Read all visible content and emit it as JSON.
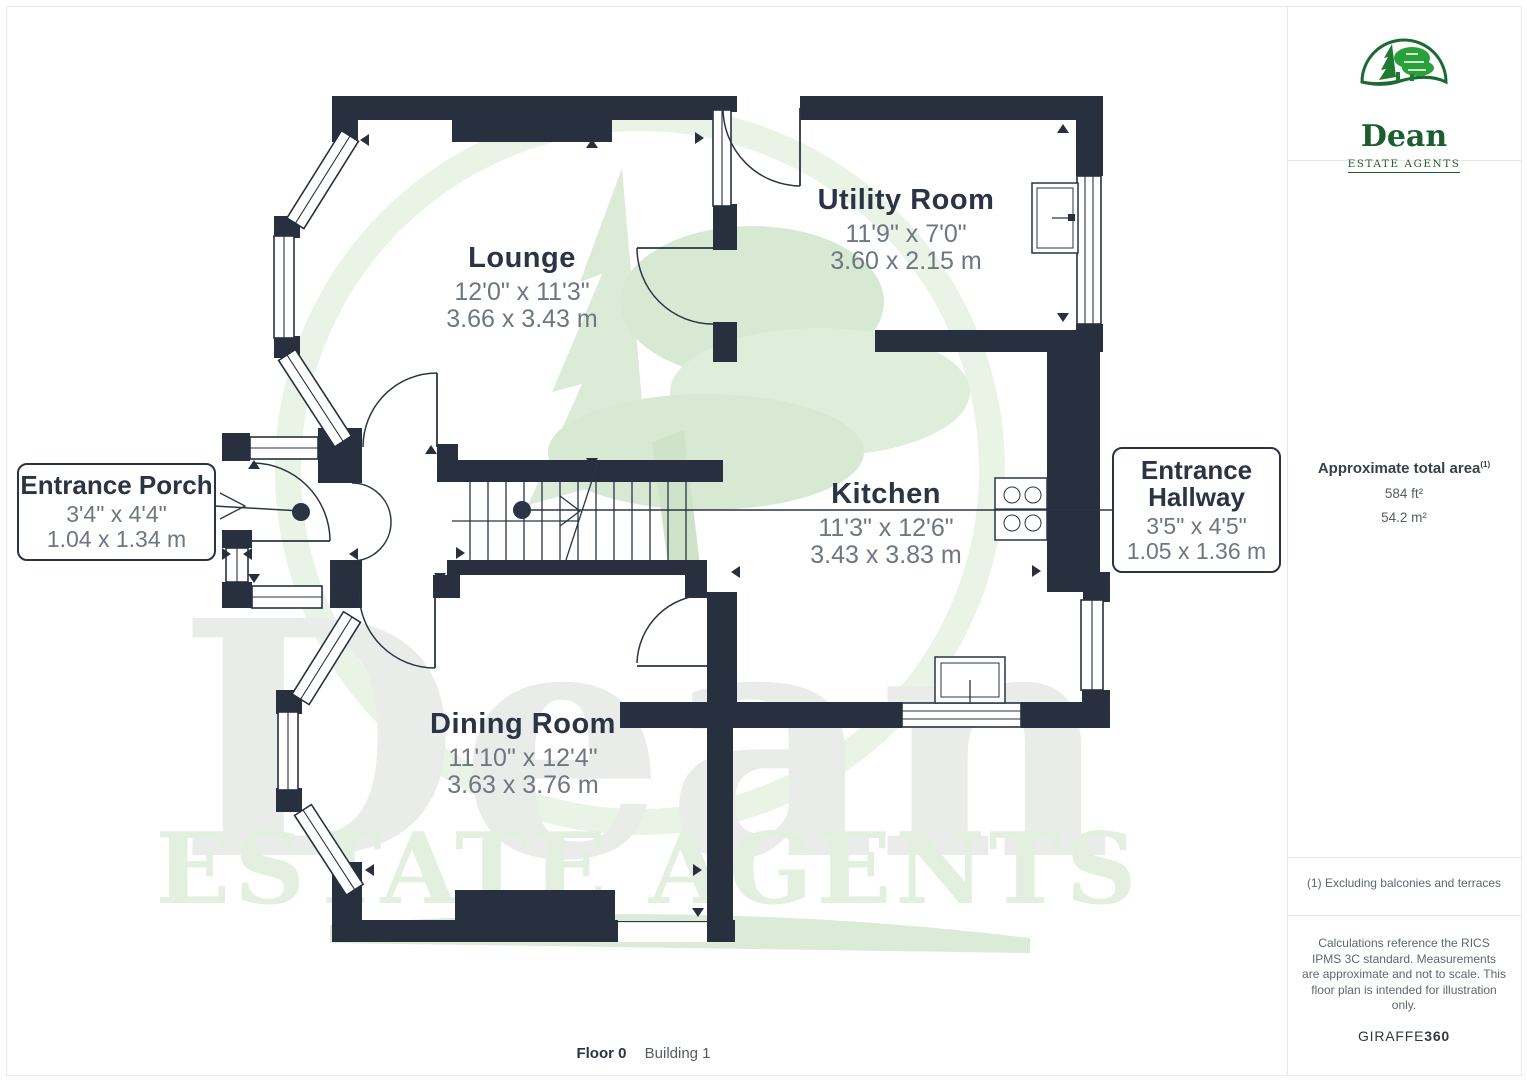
{
  "plan": {
    "rooms": [
      {
        "name": "Lounge",
        "imperial": "12'0\" x 11'3\"",
        "metric": "3.66 x 3.43 m"
      },
      {
        "name": "Utility Room",
        "imperial": "11'9\" x 7'0\"",
        "metric": "3.60 x 2.15 m"
      },
      {
        "name": "Kitchen",
        "imperial": "11'3\" x 12'6\"",
        "metric": "3.43 x 3.83 m"
      },
      {
        "name": "Dining Room",
        "imperial": "11'10\" x 12'4\"",
        "metric": "3.63 x 3.76 m"
      }
    ],
    "callouts": [
      {
        "name": "Entrance Porch",
        "imperial": "3'4\" x 4'4\"",
        "metric": "1.04 x 1.34 m"
      },
      {
        "line1": "Entrance",
        "line2": "Hallway",
        "imperial": "3'5\" x 4'5\"",
        "metric": "1.05 x 1.36 m"
      }
    ]
  },
  "watermark": {
    "word": "Dean",
    "tagline": "ESTATE AGENTS"
  },
  "sidebar": {
    "logo": {
      "name": "Dean",
      "tagline": "ESTATE AGENTS"
    },
    "area": {
      "label": "Approximate total area",
      "superscript": "(1)",
      "imperial": "584 ft²",
      "metric": "54.2 m²"
    },
    "footnote": "(1) Excluding balconies and terraces",
    "disclaimer": "Calculations reference the RICS IPMS 3C standard. Measurements are approximate and not to scale. This floor plan is intended for illustration only.",
    "brand": {
      "name": "GIRAFFE",
      "suffix": "360"
    }
  },
  "footer": {
    "floor_label": "Floor 0",
    "building_label": "Building 1"
  },
  "colors": {
    "wall": "#283040",
    "text_dark": "#2b3444",
    "text_gray": "#6f7681",
    "logo_green": "#1b5e2f",
    "tree_green": "#2aa03a",
    "watermark_green": "#e3f0e0",
    "watermark_gray": "#eaecea"
  }
}
